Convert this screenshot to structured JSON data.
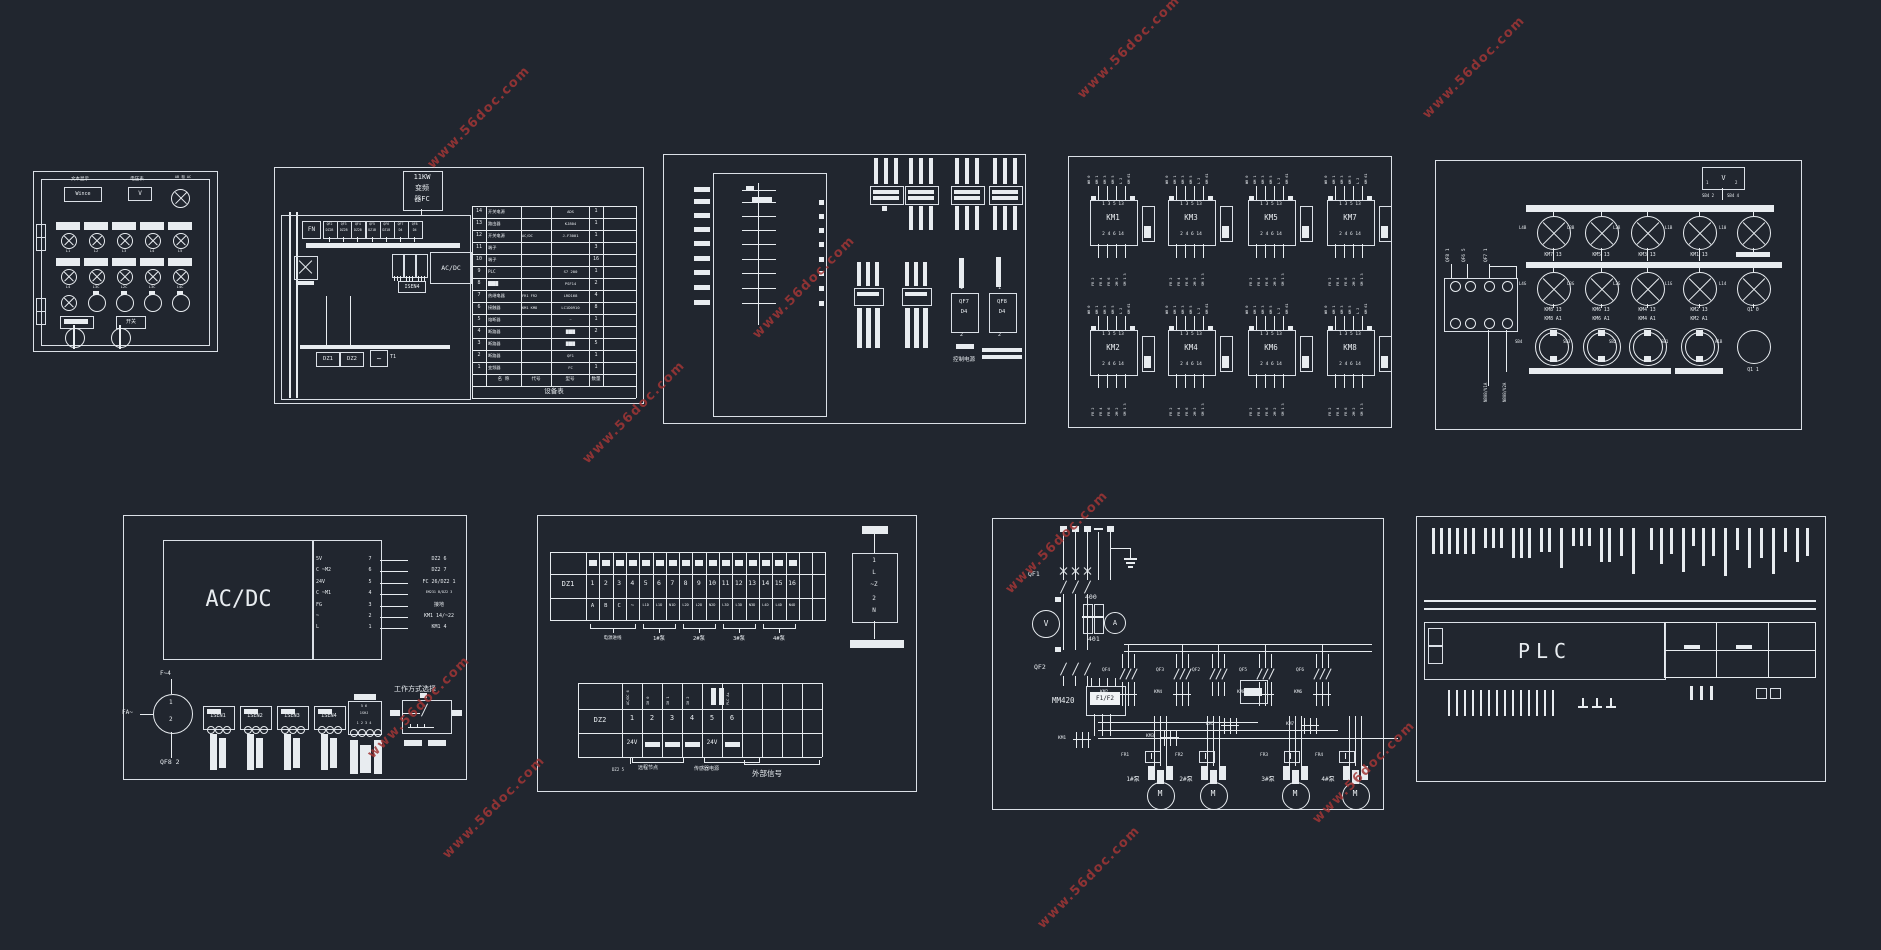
{
  "watermark": {
    "text": "www.56doc.com",
    "color": "#a23636"
  },
  "panel1": {
    "title_left": "文本显示",
    "display_value": "Wince",
    "title_mid": "电压表",
    "voltmeter": "V",
    "title_right": "AB 相 AC",
    "switch_label": "开关",
    "row1_tags": [
      "L1",
      "L2",
      "L3",
      "L4",
      "L5"
    ],
    "row2_tags": [
      "L4",
      "L3C",
      "L2C",
      "L3C",
      "L4C"
    ]
  },
  "panel2": {
    "fc_box": [
      "11KW",
      "变频",
      "器FC"
    ],
    "fn_label": "FN",
    "wave": "~",
    "t1_label": "T1",
    "breakers": [
      {
        "id": "QF2",
        "model": "DZ2B"
      },
      {
        "id": "QF3",
        "model": "DZ2B"
      },
      {
        "id": "QF4",
        "model": "DZ2B"
      },
      {
        "id": "QF5",
        "model": "DZ1B"
      },
      {
        "id": "QF6",
        "model": "DZ1B"
      },
      {
        "id": "QF7",
        "model": "D4"
      },
      {
        "id": "QF8",
        "model": "D4"
      }
    ],
    "acdc_label": "AC/DC",
    "isen_label": "ISEN4",
    "dz1_label": "DZ1",
    "dz2_label": "DZ2",
    "table": {
      "title": "设备表",
      "header": [
        "",
        "名 称",
        "代号",
        "型号",
        "数量"
      ],
      "rows": [
        [
          "14",
          "开关电源",
          "",
          "ADS",
          "1"
        ],
        [
          "13",
          "路由器",
          "",
          "KJ804",
          "1"
        ],
        [
          "12",
          "开关电源",
          "AC/DC",
          "J-F3001",
          "1"
        ],
        [
          "11",
          "端子",
          "",
          "",
          "3"
        ],
        [
          "10",
          "端子",
          "",
          "",
          "16"
        ],
        [
          "9",
          "PLC",
          "",
          "S7 200",
          "1"
        ],
        [
          "8",
          "████",
          "",
          "PSF14",
          "2"
        ],
        [
          "7",
          "热继电器",
          "FR1 FR2",
          "LRD168",
          "4"
        ],
        [
          "6",
          "接触器",
          "KM1 KM8",
          "LC1D0910",
          "8"
        ],
        [
          "5",
          "熔断器",
          "",
          "~",
          "1"
        ],
        [
          "4",
          "断路器",
          "",
          "████",
          "2"
        ],
        [
          "3",
          "断路器",
          "",
          "████",
          "5"
        ],
        [
          "2",
          "断路器",
          "",
          "QF1",
          "1"
        ],
        [
          "1",
          "变频器",
          "",
          "FC",
          "1"
        ]
      ]
    }
  },
  "panel3": {
    "qf7": {
      "t": "1",
      "l1": "QF7",
      "l2": "D4",
      "b": "2"
    },
    "qf8": {
      "t": "1",
      "l1": "QF8",
      "l2": "D4",
      "b": "2"
    },
    "ctrl_label": "控制电源"
  },
  "panel4": {
    "relays": [
      {
        "name": "KM1"
      },
      {
        "name": "KM3"
      },
      {
        "name": "KM5"
      },
      {
        "name": "KM7"
      },
      {
        "name": "KM2"
      },
      {
        "name": "KM4"
      },
      {
        "name": "KM6"
      },
      {
        "name": "KM8"
      }
    ],
    "pins_top": "1 3 5 13",
    "pins_bottom": "2 4 6 14",
    "tags_top": [
      "W0 0",
      "KM 1",
      "KM 3",
      "KM 5",
      "L 2",
      "KM 61"
    ],
    "tags_bottom": [
      "FR 2",
      "FR 4",
      "FR 6",
      "2M 2",
      "SM 1 3"
    ]
  },
  "panel5": {
    "vmeter": {
      "label": "V",
      "p1": "1",
      "p2": "2",
      "w1": "SB4 2",
      "w2": "SB4 4"
    },
    "qf_tags": [
      "QF8 1",
      "QF6 5",
      "QF7 1"
    ],
    "wire_tags": [
      "N808/V1A",
      "N808/V2A"
    ],
    "lamp_rows": {
      "r1_tags": [
        "L4B",
        "L3B",
        "L2B",
        "L1B",
        "L10"
      ],
      "r1_labels": [
        "KM7 13",
        "KM5 13",
        "KM3 13",
        "KM1 13",
        ""
      ],
      "r2_tags": [
        "L4G",
        "L3G",
        "L2G",
        "L1G",
        "L14"
      ],
      "r2_labels": [
        "KM8 13",
        "KM6 13",
        "KM4 13",
        "KM2 13",
        "Q1 0"
      ],
      "r3_top": [
        "KM8 A1",
        "KM6 A1",
        "KM4 A1",
        "KM2 A1",
        ""
      ],
      "r3_tags": [
        "SB4",
        "SB3",
        "SB2",
        "SB1",
        "A1B"
      ],
      "r3_bottom": [
        "",
        "",
        "",
        "",
        "Q1 1"
      ]
    }
  },
  "panel6": {
    "acdc": "AC/DC",
    "pins": [
      [
        "5V",
        "7"
      ],
      [
        "C ~M2",
        "6"
      ],
      [
        "24V",
        "5"
      ],
      [
        "C ~M1",
        "4"
      ],
      [
        "FG",
        "3"
      ],
      [
        "~",
        "2"
      ],
      [
        "L",
        "1"
      ]
    ],
    "wires": [
      "DZ2 6",
      "DZ2 7",
      "FC 26/DZ2 1",
      "EM231 B/DZ2 3",
      "接地",
      "KM1 14/~22",
      "KM1 4"
    ],
    "fuse_top": "F~4",
    "fa": "FA~",
    "meter_1": "1",
    "meter_2": "2",
    "qf8": "QF8 2",
    "isen": [
      "ISEN1",
      "ISEN2",
      "ISEN3",
      "ISEN4"
    ],
    "sensor": {
      "t": "5 6",
      "m": "1SHJ",
      "b": "1 2 3 4"
    },
    "mode_label": "工作方式选择"
  },
  "panel7": {
    "dz1": {
      "label": "DZ1",
      "numbers": [
        "1",
        "2",
        "3",
        "4",
        "5",
        "6",
        "7",
        "8",
        "9",
        "10",
        "11",
        "12",
        "13",
        "14",
        "15",
        "16",
        "",
        ""
      ],
      "bottom": [
        "A",
        "B",
        "C",
        "~",
        "L1D",
        "L1D",
        "N1D",
        "L2D",
        "L2D",
        "N2D",
        "L3D",
        "L3D",
        "N3D",
        "L4D",
        "L4D",
        "N4D",
        "",
        ""
      ]
    },
    "groups": [
      "电源进线",
      "1#泵",
      "2#泵",
      "3#泵",
      "4#泵"
    ],
    "filter": [
      "1",
      "L",
      "~Z",
      "2",
      "N"
    ],
    "dz2": {
      "label": "DZ2",
      "top": [
        "AC/DC 6",
        "I0 0",
        "I0 1",
        "I0 2",
        "",
        "PLC A+",
        "",
        "",
        "",
        ""
      ],
      "numbers": [
        "1",
        "2",
        "3",
        "4",
        "5",
        "6",
        "",
        "",
        "",
        ""
      ],
      "bottom": [
        "24V",
        "",
        "",
        "",
        "24V",
        "",
        "",
        "",
        "",
        ""
      ]
    },
    "notes": [
      "DZ2 5",
      "远程节点",
      "传感器电源",
      "外部信号"
    ]
  },
  "panel8": {
    "qf1": "QF1",
    "v": "V",
    "a": "A",
    "t400": "400",
    "t401": "401",
    "qf2": "QF2",
    "mm420": "MM420",
    "f1f2": "F1/F2",
    "branch_qf": [
      "QF4",
      "QF3",
      "QF2",
      "QF5",
      "QF6"
    ],
    "branch_km": [
      "KM2",
      "KM4",
      "KM8",
      "KM6"
    ],
    "low_km": [
      "KM1",
      "KM3",
      "KM5",
      "KM7"
    ],
    "fr": [
      "FR1",
      "FR2",
      "FR3",
      "FR4"
    ],
    "pumps": [
      "1#泵",
      "2#泵",
      "3#泵",
      "4#泵"
    ],
    "motor": "M"
  },
  "panel9": {
    "plc": "PLC"
  }
}
